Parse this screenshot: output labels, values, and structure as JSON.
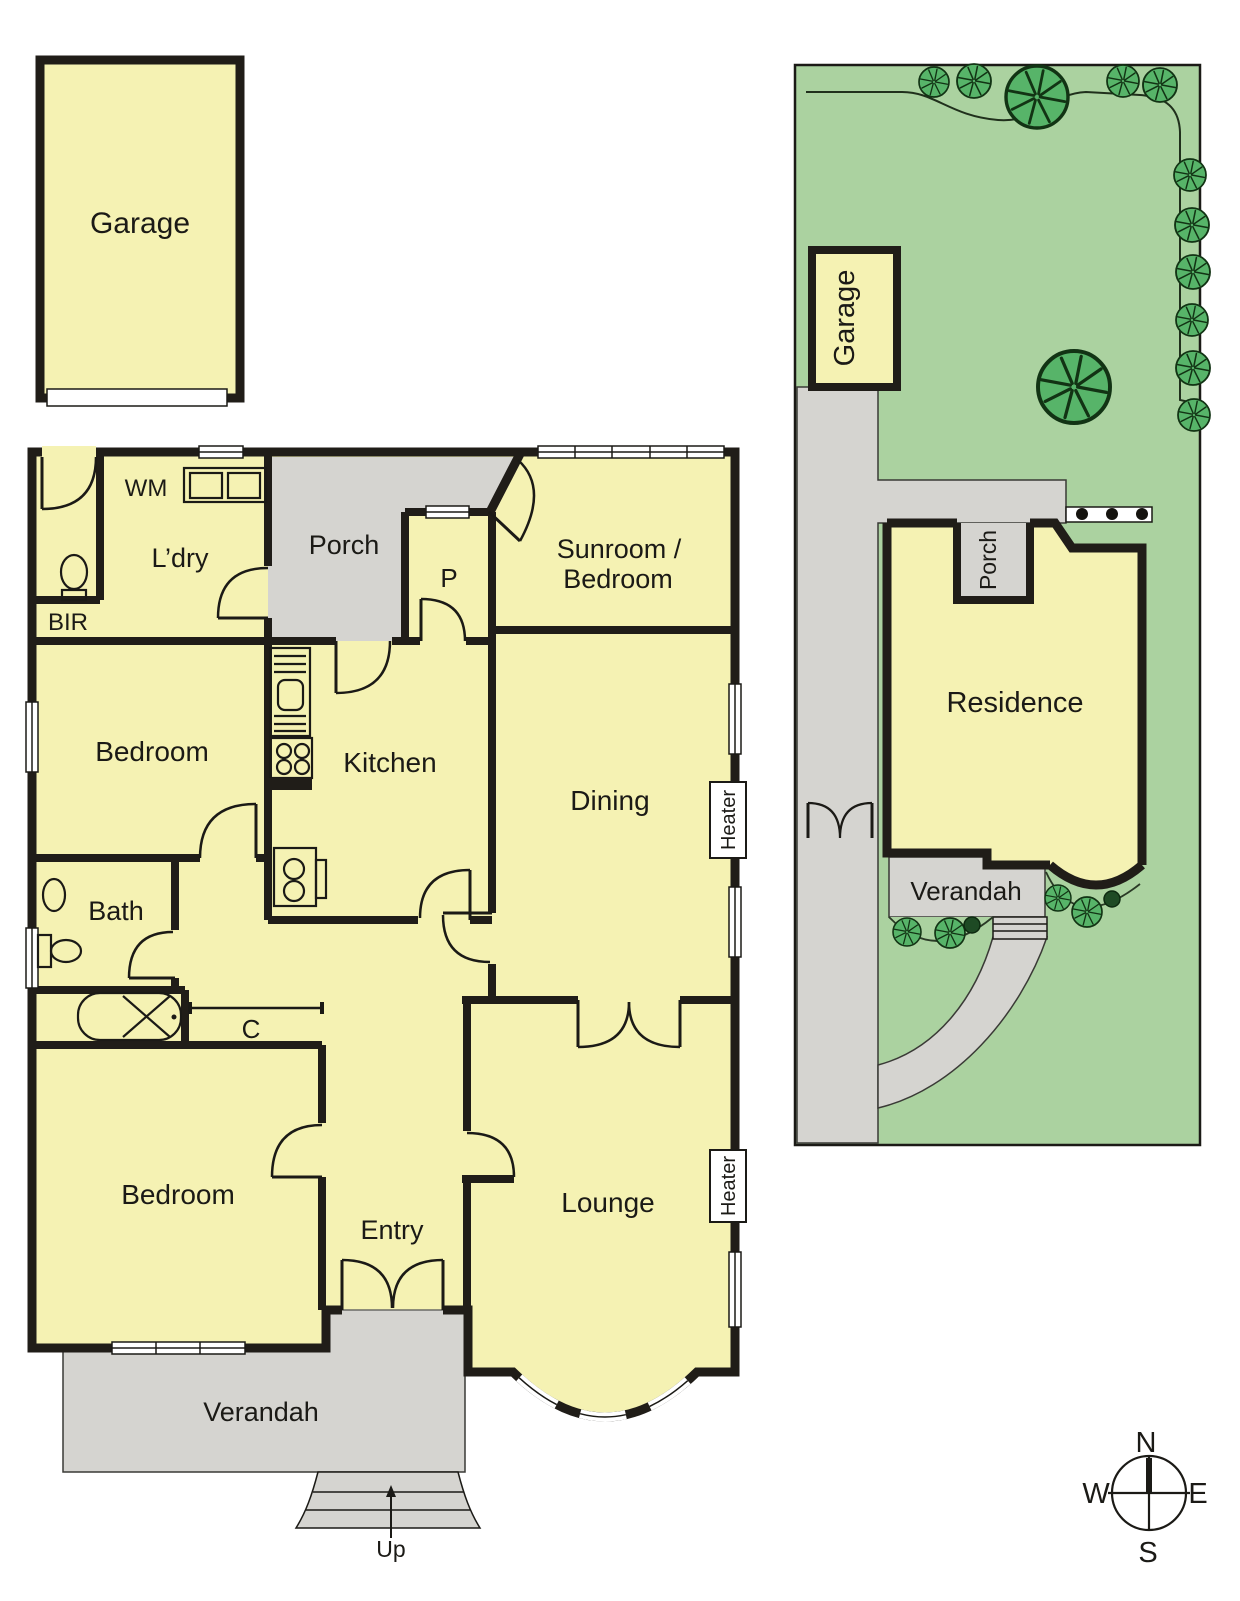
{
  "floor_plan": {
    "garage": "Garage",
    "laundry": "L’dry",
    "washing_machine": "WM",
    "built_in_robe": "BIR",
    "porch": "Porch",
    "pantry": "P",
    "sunroom_line1": "Sunroom /",
    "sunroom_line2": "Bedroom",
    "bedroom_front": "Bedroom",
    "kitchen": "Kitchen",
    "dining": "Dining",
    "heater_dining": "Heater",
    "bath": "Bath",
    "cupboard": "C",
    "bedroom_rear": "Bedroom",
    "entry": "Entry",
    "lounge": "Lounge",
    "heater_lounge": "Heater",
    "verandah": "Verandah",
    "steps_up": "Up"
  },
  "site_plan": {
    "garage": "Garage",
    "porch": "Porch",
    "residence": "Residence",
    "verandah": "Verandah"
  },
  "compass": {
    "north": "N",
    "east": "E",
    "south": "S",
    "west": "W"
  },
  "icons": {
    "tree": "tree-icon",
    "shrub": "shrub-icon",
    "bush": "bush-icon",
    "compass": "compass-rose",
    "stairs": "stairs-icon",
    "up_arrow": "up-arrow-icon"
  },
  "colors": {
    "room_fill": "#F5F2B3",
    "outdoor_fill": "#D5D4D0",
    "wall": "#201D18",
    "lawn": "#ABD2A0",
    "tree": "#57B469",
    "bush_dark": "#1E4A24",
    "window": "#FFFFFF",
    "text": "#1B1A16"
  }
}
